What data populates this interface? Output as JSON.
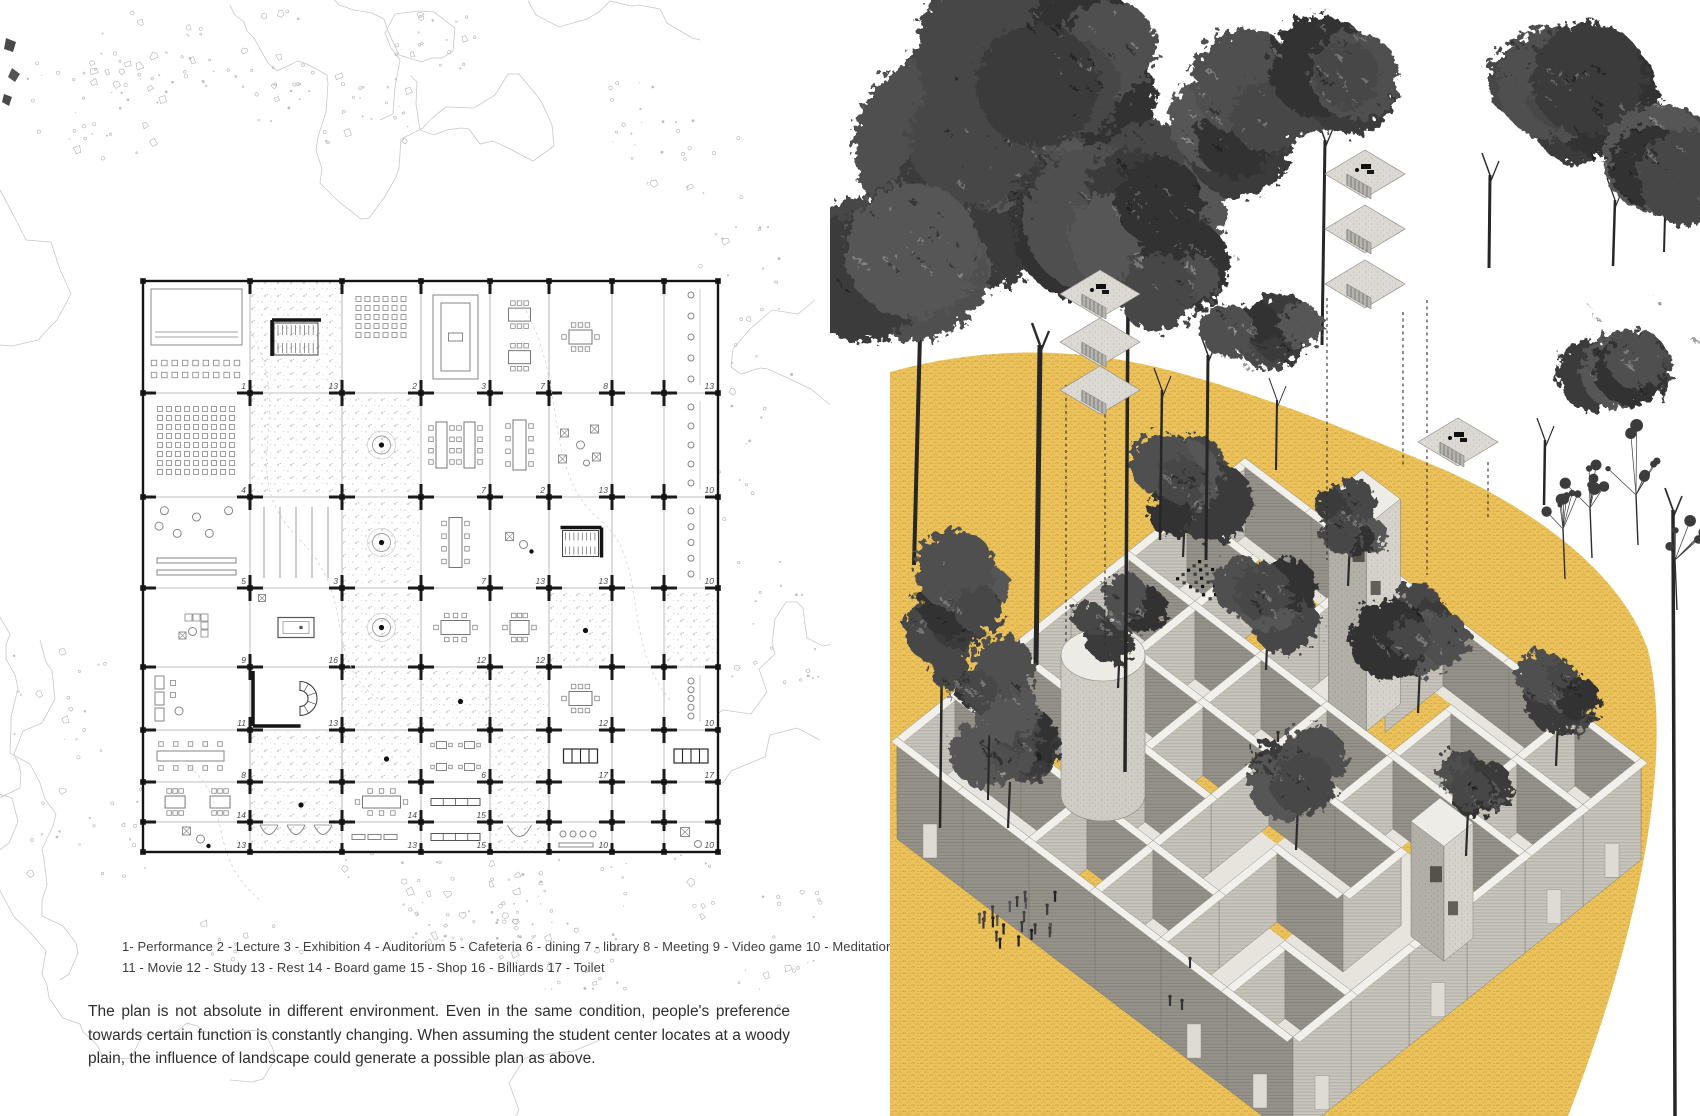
{
  "page": {
    "width": 1700,
    "height": 1116,
    "background": "#ffffff"
  },
  "left_panel": {
    "legend": {
      "line1": "1- Performance 2 - Lecture 3 - Exhibition 4 - Auditorium 5 - Cafeteria 6 - dining 7 - library 8 - Meeting 9 - Video game 10 - Meditation",
      "line2": "11 - Movie 12 - Study 13 - Rest 14 - Board game 15 - Shop 16 - Billiards 17 - Toilet"
    },
    "caption": "The plan is not absolute in different environment. Even in the same condition, people's preference towards certain function is constantly changing. When assuming the student center locates at a woody plain, the influence of landscape could generate a possible plan as above.",
    "floor_plan": {
      "col_edges": [
        143,
        250,
        342,
        421,
        490,
        549,
        612,
        664,
        718
      ],
      "row_edges": [
        281,
        393,
        497,
        588,
        667,
        730,
        782,
        822,
        852
      ],
      "cells": [
        [
          {
            "n": "1",
            "m": "stage",
            "c": 0
          },
          {
            "n": "13",
            "m": "ust",
            "c": 1
          },
          {
            "n": "2",
            "m": "sg5",
            "c": 0
          },
          {
            "n": "3",
            "m": "conc",
            "c": 0
          },
          {
            "n": "7",
            "m": "t2",
            "c": 0
          },
          {
            "n": "8",
            "m": "meet",
            "c": 0
          },
          {
            "n": "",
            "m": "",
            "c": 0
          },
          {
            "n": "13",
            "m": "chc",
            "c": 0
          }
        ],
        [
          {
            "n": "4",
            "m": "sg8",
            "c": 0
          },
          {
            "n": "",
            "m": "",
            "c": 1
          },
          {
            "n": "",
            "m": "tdot",
            "c": 1
          },
          {
            "n": "7",
            "m": "lt2",
            "c": 0
          },
          {
            "n": "2",
            "m": "lt1",
            "c": 0
          },
          {
            "n": "13",
            "m": "lng",
            "c": 0
          },
          {
            "n": "",
            "m": "",
            "c": 0
          },
          {
            "n": "10",
            "m": "chc",
            "c": 0
          }
        ],
        [
          {
            "n": "5",
            "m": "cir",
            "c": 0
          },
          {
            "n": "3",
            "m": "vln",
            "c": 0
          },
          {
            "n": "",
            "m": "tdot",
            "c": 1
          },
          {
            "n": "7",
            "m": "lt1",
            "c": 0
          },
          {
            "n": "13",
            "m": "sfd",
            "c": 0
          },
          {
            "n": "13",
            "m": "us2",
            "c": 0
          },
          {
            "n": "",
            "m": "",
            "c": 0
          },
          {
            "n": "10",
            "m": "chc",
            "c": 0
          }
        ],
        [
          {
            "n": "9",
            "m": "sofL",
            "c": 0
          },
          {
            "n": "16",
            "m": "bil",
            "c": 0
          },
          {
            "n": "",
            "m": "tdot",
            "c": 1
          },
          {
            "n": "12",
            "m": "meet",
            "c": 0
          },
          {
            "n": "12",
            "m": "meet",
            "c": 0
          },
          {
            "n": "",
            "m": "dot",
            "c": 1
          },
          {
            "n": "",
            "m": "",
            "c": 0
          },
          {
            "n": "",
            "m": "",
            "c": 1
          }
        ],
        [
          {
            "n": "11",
            "m": "sfr",
            "c": 0
          },
          {
            "n": "13",
            "m": "spi",
            "c": 0
          },
          {
            "n": "",
            "m": "",
            "c": 1
          },
          {
            "n": "",
            "m": "dot",
            "c": 1
          },
          {
            "n": "",
            "m": "",
            "c": 1
          },
          {
            "n": "12",
            "m": "meet",
            "c": 0
          },
          {
            "n": "",
            "m": "",
            "c": 0
          },
          {
            "n": "10",
            "m": "chc",
            "c": 0
          }
        ],
        [
          {
            "n": "8",
            "m": "tbr",
            "c": 0
          },
          {
            "n": "",
            "m": "",
            "c": 1
          },
          {
            "n": "",
            "m": "dot",
            "c": 1
          },
          {
            "n": "6",
            "m": "t4",
            "c": 0
          },
          {
            "n": "",
            "m": "",
            "c": 1
          },
          {
            "n": "17",
            "m": "stl",
            "c": 0
          },
          {
            "n": "",
            "m": "",
            "c": 0
          },
          {
            "n": "17",
            "m": "stl",
            "c": 0
          }
        ],
        [
          {
            "n": "14",
            "m": "t2",
            "c": 0
          },
          {
            "n": "",
            "m": "dot",
            "c": 1
          },
          {
            "n": "14",
            "m": "lth",
            "c": 0
          },
          {
            "n": "15",
            "m": "cnt",
            "c": 0
          },
          {
            "n": "",
            "m": "",
            "c": 1
          },
          {
            "n": "",
            "m": "",
            "c": 0
          },
          {
            "n": "",
            "m": "",
            "c": 0
          },
          {
            "n": "",
            "m": "",
            "c": 0
          }
        ],
        [
          {
            "n": "13",
            "m": "sfd",
            "c": 0
          },
          {
            "n": "",
            "m": "arc3",
            "c": 1
          },
          {
            "n": "13",
            "m": "ben",
            "c": 0
          },
          {
            "n": "15",
            "m": "cnt",
            "c": 0
          },
          {
            "n": "",
            "m": "arc1",
            "c": 1
          },
          {
            "n": "10",
            "m": "dtr",
            "c": 0
          },
          {
            "n": "",
            "m": "",
            "c": 0
          },
          {
            "n": "10",
            "m": "hch",
            "c": 0
          }
        ]
      ]
    }
  },
  "right_panel": {
    "colors": {
      "ground_yellow": "#ebc25c",
      "ground_texture": "#cf9f35",
      "tree_dark": "#3f3f3f",
      "wall_dark": "#96938b",
      "wall_light": "#c7c4bc",
      "wall_top": "#f2f0ea",
      "floor": "#e7e4dd"
    },
    "blob_path": "M60,372 C140,350 230,344 330,368 C420,390 520,430 615,470 C700,508 790,570 818,650 C840,740 822,900 738,1116 L60,1116 Z",
    "building": {
      "top": [
        415,
        458
      ],
      "bay_a": [
        66,
        50
      ],
      "bay_b": [
        -58,
        46.5
      ],
      "bays": 6,
      "wall_height": 78,
      "courtyards": [
        [
          1,
          1
        ],
        [
          2,
          3
        ],
        [
          3,
          1
        ],
        [
          4,
          4
        ],
        [
          1,
          4
        ],
        [
          3,
          3
        ],
        [
          5,
          2
        ],
        [
          2,
          5
        ]
      ]
    },
    "canopies": [
      [
        180,
        140,
        150,
        0
      ],
      [
        85,
        250,
        105,
        0
      ],
      [
        300,
        200,
        115,
        0
      ],
      [
        250,
        60,
        90,
        0
      ],
      [
        390,
        120,
        78,
        0
      ],
      [
        420,
        330,
        80,
        1
      ],
      [
        355,
        265,
        70,
        0
      ],
      [
        495,
        75,
        75,
        0
      ],
      [
        735,
        85,
        85,
        0
      ],
      [
        825,
        160,
        80,
        0
      ],
      [
        800,
        360,
        95,
        1
      ],
      [
        120,
        600,
        60,
        0
      ],
      [
        150,
        690,
        52,
        0
      ]
    ],
    "trunks": [
      [
        90,
        335,
        84,
        565,
        4
      ],
      [
        210,
        345,
        206,
        665,
        5
      ],
      [
        298,
        300,
        295,
        772,
        3.5
      ],
      [
        332,
        390,
        330,
        540,
        2.5
      ],
      [
        378,
        355,
        376,
        560,
        3
      ],
      [
        447,
        400,
        446,
        470,
        2
      ],
      [
        495,
        140,
        492,
        345,
        3
      ],
      [
        660,
        175,
        659,
        268,
        3
      ],
      [
        785,
        200,
        783,
        266,
        2.5
      ],
      [
        835,
        215,
        834,
        252,
        2
      ],
      [
        715,
        440,
        714,
        505,
        2.5
      ],
      [
        843,
        510,
        845,
        1116,
        3.5
      ],
      [
        112,
        650,
        110,
        828,
        2.5
      ],
      [
        160,
        700,
        158,
        800,
        2
      ]
    ],
    "inner_trees": [
      [
        355,
        480,
        62
      ],
      [
        290,
        618,
        48
      ],
      [
        438,
        598,
        52
      ],
      [
        590,
        638,
        58
      ],
      [
        180,
        758,
        48
      ],
      [
        468,
        778,
        52
      ],
      [
        638,
        788,
        44
      ],
      [
        728,
        698,
        44
      ],
      [
        520,
        520,
        40
      ]
    ],
    "shrubs": [
      [
        806,
        455,
        40
      ],
      [
        760,
        478,
        30
      ],
      [
        733,
        503,
        26
      ],
      [
        845,
        530,
        30
      ]
    ],
    "stair_stacks": [
      [
        270,
        292,
        3,
        48
      ],
      [
        535,
        172,
        3,
        55
      ],
      [
        628,
        440,
        1,
        0
      ]
    ],
    "leaders": [
      [
        236,
        385,
        236,
        645
      ],
      [
        275,
        408,
        275,
        645
      ],
      [
        497,
        298,
        497,
        560
      ],
      [
        573,
        312,
        573,
        468
      ],
      [
        597,
        300,
        597,
        575
      ],
      [
        658,
        462,
        658,
        520
      ]
    ],
    "crowd": {
      "cx": 190,
      "cy": 925,
      "count": 22,
      "rx": 42,
      "ry": 26
    },
    "singles": [
      [
        352,
        1010
      ],
      [
        340,
        1006
      ],
      [
        360,
        968
      ],
      [
        448,
        742
      ]
    ],
    "tower": {
      "top": [
        532,
        470
      ],
      "scale": 0.58,
      "height": 205
    },
    "cylinder": {
      "cx": 273,
      "cy": 655,
      "rx": 42,
      "ry": 26,
      "height": 140
    },
    "cube": {
      "top": [
        610,
        798
      ],
      "scale": 0.5,
      "height": 115
    },
    "seats_checker": {
      "x": 368,
      "y": 560,
      "cols": 6,
      "rows": 5
    }
  }
}
